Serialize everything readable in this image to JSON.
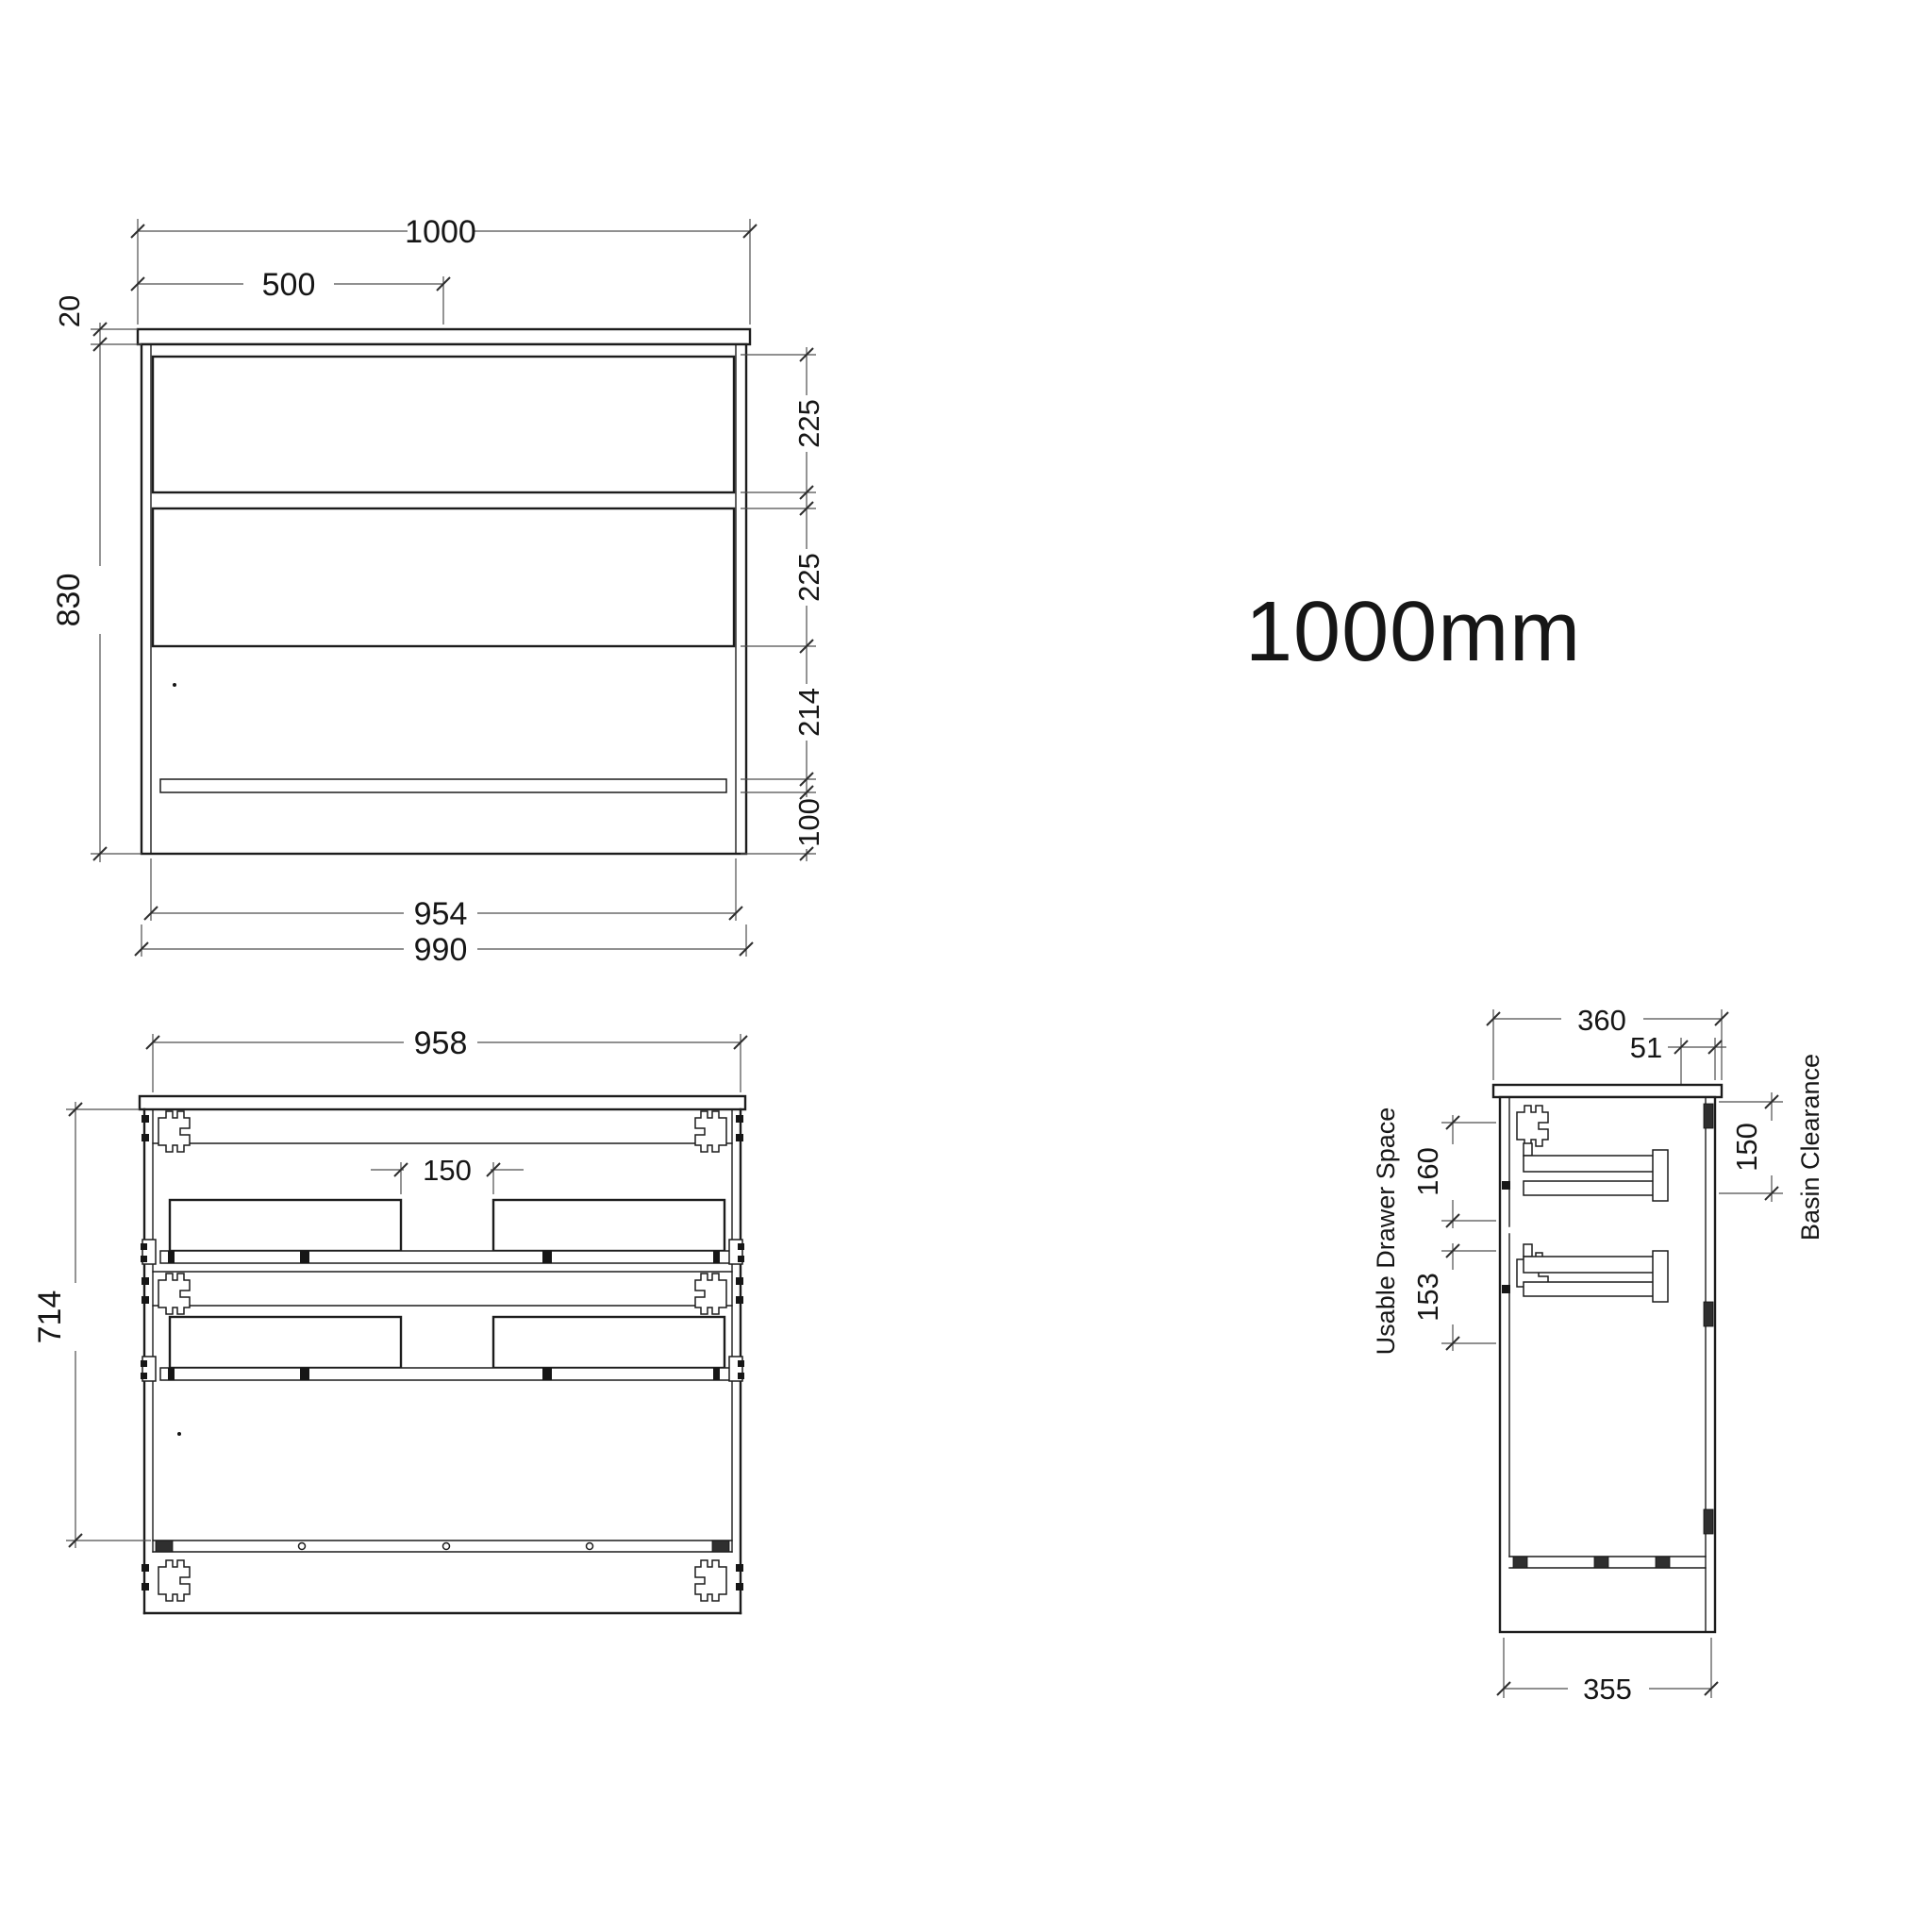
{
  "title": {
    "size_label": "1000mm"
  },
  "front_view": {
    "dims": {
      "overall_width": "1000",
      "half_width": "500",
      "top_thickness": "20",
      "height": "830",
      "drawer1": "225",
      "drawer2": "225",
      "lower_section": "214",
      "kick": "100",
      "carcass_width": "954",
      "body_width": "990"
    }
  },
  "internal_view": {
    "dims": {
      "width": "958",
      "height": "714",
      "centre_gap": "150"
    }
  },
  "side_view": {
    "dims": {
      "depth": "360",
      "waste_offset": "51",
      "basin_clearance": "150",
      "drawer1_space": "160",
      "drawer2_space": "153",
      "base_depth": "355"
    },
    "labels": {
      "usable_drawer_space": "Usable Drawer Space",
      "basin_clearance": "Basin Clearance"
    }
  }
}
